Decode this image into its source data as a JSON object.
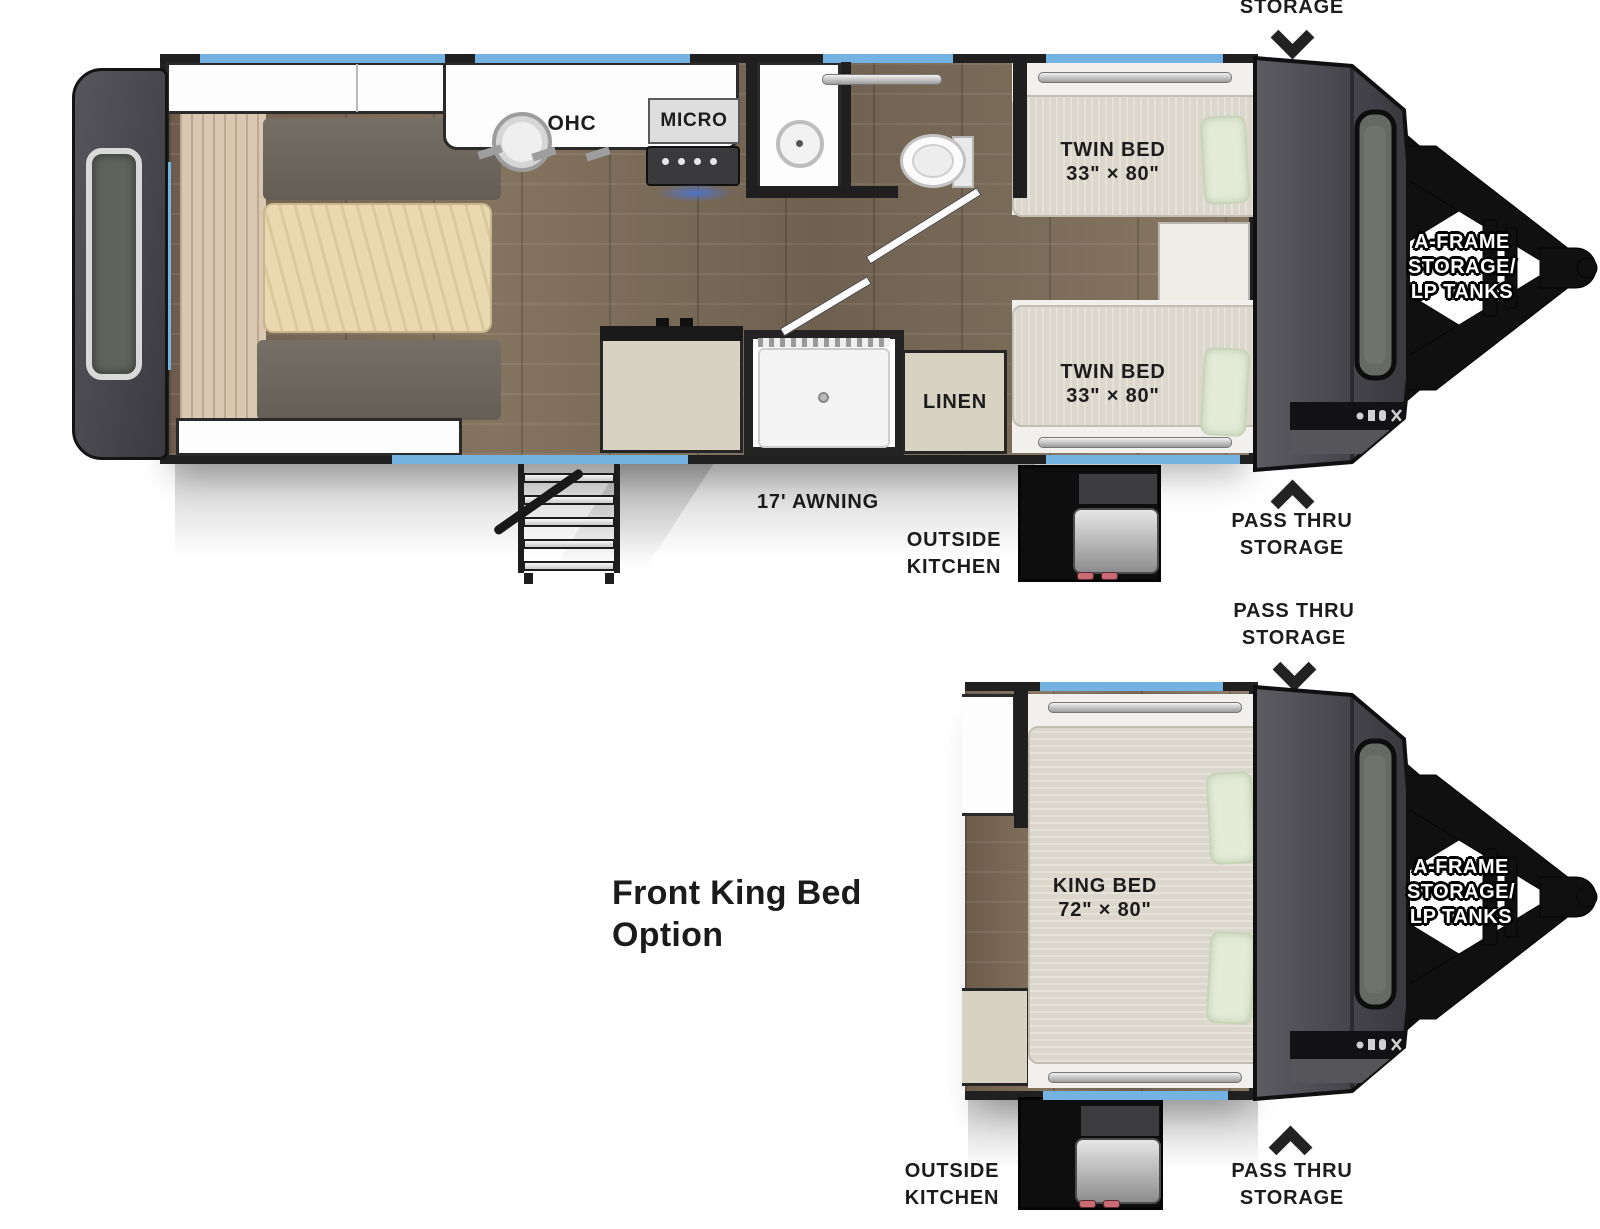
{
  "top_plan": {
    "top_label": {
      "line1": "STORAGE"
    },
    "rooms": {
      "ohc_rear": "OHC",
      "dinette": "DINETTE",
      "shelves": "SHELVES",
      "ohc_kitchen": "OHC",
      "micro": "MICRO",
      "fridge": "FRIDGE",
      "linen": "LINEN",
      "twin_bed_top": {
        "line1": "TWIN BED",
        "line2": "33\" × 80\""
      },
      "twin_bed_bottom": {
        "line1": "TWIN BED",
        "line2": "33\" × 80\""
      }
    },
    "exterior": {
      "awning": "17' AWNING",
      "outside_kitchen": {
        "line1": "OUTSIDE",
        "line2": "KITCHEN"
      },
      "pass_thru": {
        "line1": "PASS THRU",
        "line2": "STORAGE"
      },
      "aframe": {
        "line1": "A-FRAME",
        "line2": "STORAGE/",
        "line3": "LP TANKS"
      }
    }
  },
  "bottom_plan": {
    "title": {
      "line1": "Front King Bed",
      "line2": "Option"
    },
    "rooms": {
      "king_bed": {
        "line1": "KING BED",
        "line2": "72\" × 80\""
      }
    },
    "exterior": {
      "pass_thru_top": {
        "line1": "PASS THRU",
        "line2": "STORAGE"
      },
      "pass_thru_bottom": {
        "line1": "PASS THRU",
        "line2": "STORAGE"
      },
      "outside_kitchen": {
        "line1": "OUTSIDE",
        "line2": "KITCHEN"
      },
      "aframe": {
        "line1": "A-FRAME",
        "line2": "STORAGE/",
        "line3": "LP TANKS"
      }
    }
  },
  "colors": {
    "accent_blue": "#74b2e2",
    "wall_black": "#202020",
    "cap_gray": "#4a4a4e",
    "cabinet_beige": "#d8d2c3",
    "floor_wood": "#79695a",
    "pillow_green": "#e4ecd9",
    "label_black": "#1c1c1c",
    "aframe_text_white": "#ffffff"
  }
}
